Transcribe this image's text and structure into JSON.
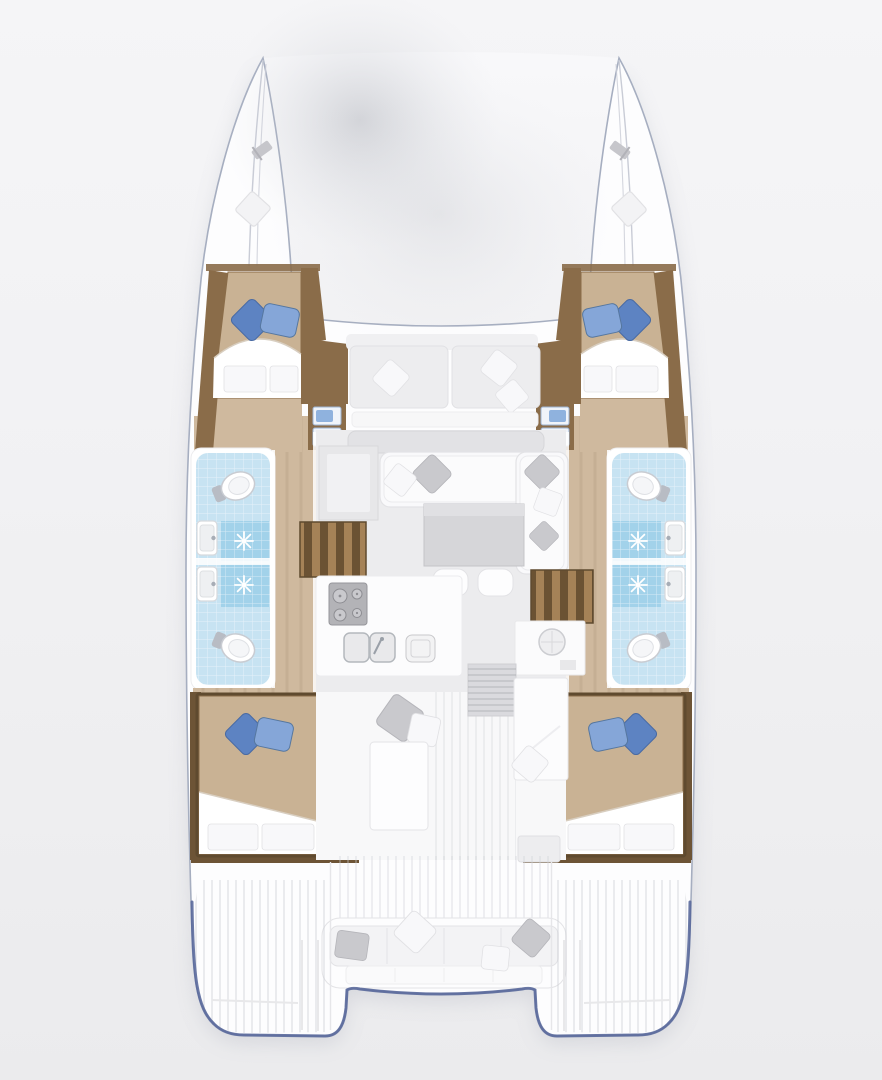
{
  "meta": {
    "subject": "Catamaran yacht deck plan, overhead top-down interior layout",
    "canvas_px": {
      "width": 882,
      "height": 1080
    }
  },
  "palette": {
    "background": "#f1f1f3",
    "background_top": "#f5f5f7",
    "background_bottom": "#ebebed",
    "deck_white": "#fdfdfe",
    "hull_line": "#a6aec0",
    "stern_accent": "#56679a",
    "wood_floor": "#cfb99e",
    "wood_trim": "#8a6c49",
    "wood_trim_dark": "#6d5436",
    "stair_dark": "#6b5233",
    "stair_light": "#a58257",
    "bed_linen": "#c9b294",
    "pillow_blue": "#5d83c2",
    "pillow_blue_light": "#85a6d8",
    "bath_floor": "#c7e3f2",
    "shower_tile": "#a2d2ea",
    "saloon_floor": "#ececee",
    "furniture_white": "#f9f9fb",
    "table_gray": "#d6d6d9",
    "appliance_gray": "#b3b3b7",
    "pillow_gray": "#c9c9cd"
  },
  "vessel": {
    "type": "sailing catamaran",
    "view": "overhead interior floor plan",
    "hull_count": 2,
    "cabin_count": 4,
    "bathroom_count": 4,
    "areas": {
      "foredeck": {
        "label": "Foredeck and trampoline between twin bows"
      },
      "forward_cockpit": {
        "label": "Forward cockpit bench with cushions"
      },
      "port_hull": {
        "label": "Port hull interior"
      },
      "starboard_hull": {
        "label": "Starboard hull interior"
      },
      "forward_cabin": {
        "label": "Forward cabin with double berth and blue pillows"
      },
      "aft_cabin": {
        "label": "Aft cabin with double berth and blue pillows"
      },
      "bathroom": {
        "label": "Twin bathrooms with toilet, basin and shower tray"
      },
      "saloon": {
        "label": "Saloon with L-shaped sofa, table and stools"
      },
      "galley": {
        "label": "Galley with stove, double sink and worktop"
      },
      "stairs": {
        "label": "Companionway stairs to hull"
      },
      "aft_cockpit": {
        "label": "Aft cockpit bench sofa with pillows"
      },
      "swim_platform": {
        "label": "Transom swim platform with steps"
      }
    },
    "fixtures": {
      "toilets": 4,
      "wash_basins": 4,
      "shower_drains": 4,
      "berths": 4,
      "blue_pillow_pairs": 4,
      "stove_burners": 4,
      "companionways": 2,
      "mooring_cleats": 2
    }
  }
}
